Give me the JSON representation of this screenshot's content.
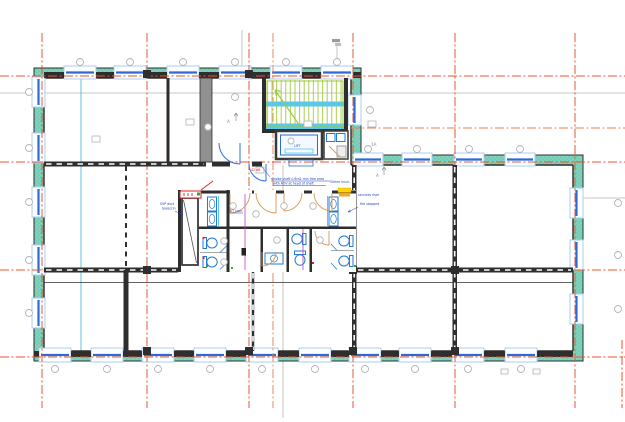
{
  "drawing": {
    "kind": "architectural-floor-plan",
    "core_labels": {
      "lift_label": "LIFT",
      "stair_section_ref": "1A",
      "section_marker_left": "A",
      "section_marker_right": "A"
    },
    "annotations": {
      "red_note": "42 dB",
      "shaft_note_line1": "SVP duct",
      "shaft_note_line2": "boxed in",
      "vt_note": "VT riser",
      "lobby_note_line1": "smoke shaft 0.6m2 min free area",
      "lobby_note_line2": "with AOV at head of shaft",
      "insul_note": "50mm insul.",
      "riser_note_line1": "services riser",
      "riser_note_line2": "fire stopped"
    },
    "colors": {
      "grid_orange": "#E8542C",
      "wall_teal": "#7FD3BC",
      "window_glass_blue": "#2B6BD9",
      "window_frame_blue": "#A9CDEF",
      "stair_green": "#9FC93C",
      "landing_cyan": "#5BC8E8",
      "fixture_blue": "#1E7BD8",
      "door_tan": "#DB9552",
      "annotation_blue": "#1F3FBF",
      "highlight_yellow": "#FFD400",
      "note_red": "#E02020",
      "section_cyan": "#49BFD8",
      "plumbing_magenta": "#BB44BB"
    }
  }
}
